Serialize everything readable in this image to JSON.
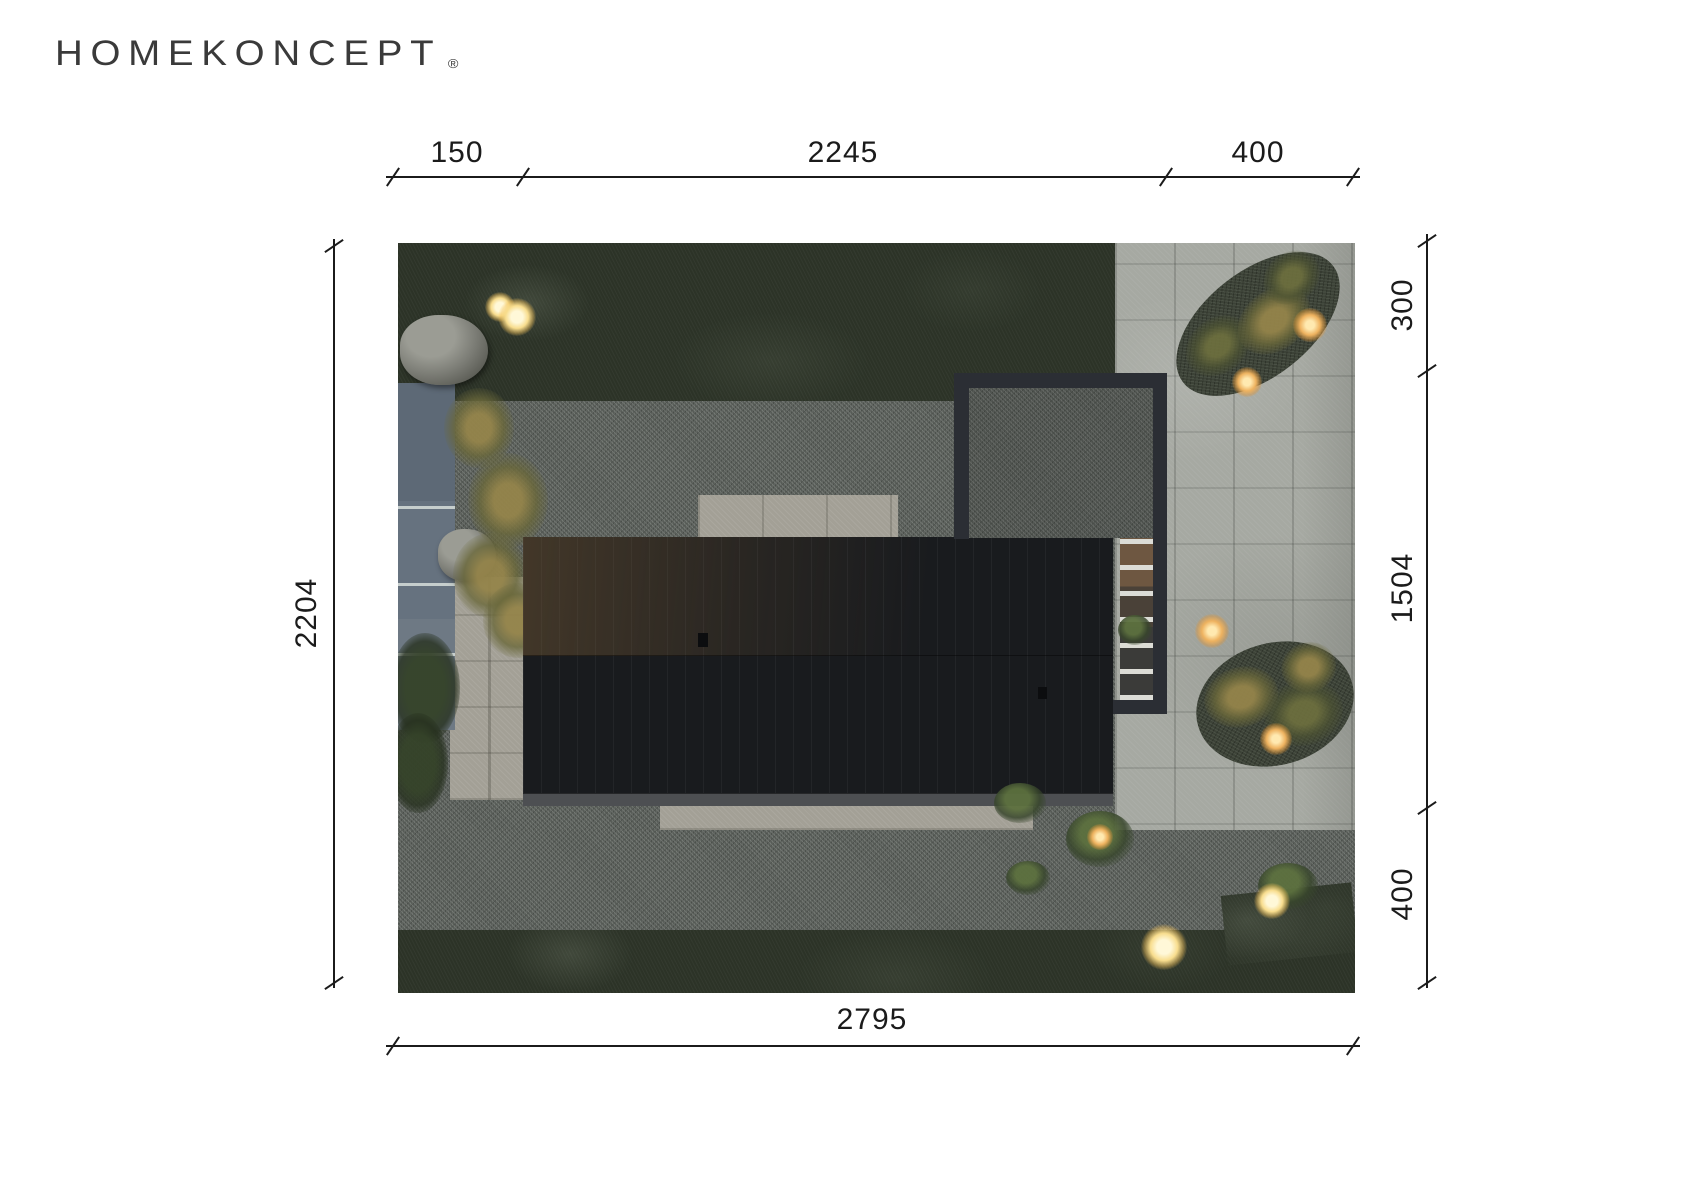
{
  "brand": {
    "name": "HOMEKONCEPT",
    "registered": "®"
  },
  "dims": {
    "top_left": "150",
    "top_mid": "2245",
    "top_right": "400",
    "left_total": "2204",
    "right_top": "300",
    "right_mid": "1504",
    "right_bottom": "400",
    "bottom_total": "2795"
  },
  "colors": {
    "drawing_line": "#1b1b1b",
    "logo_text": "#3a3a3a",
    "grass": "#2c3327",
    "gravel": "#575c57",
    "pavement": "#a6a9a2",
    "roof": "#191b1e",
    "pool": "#66727f",
    "light_glow": "#f8dd8e"
  }
}
